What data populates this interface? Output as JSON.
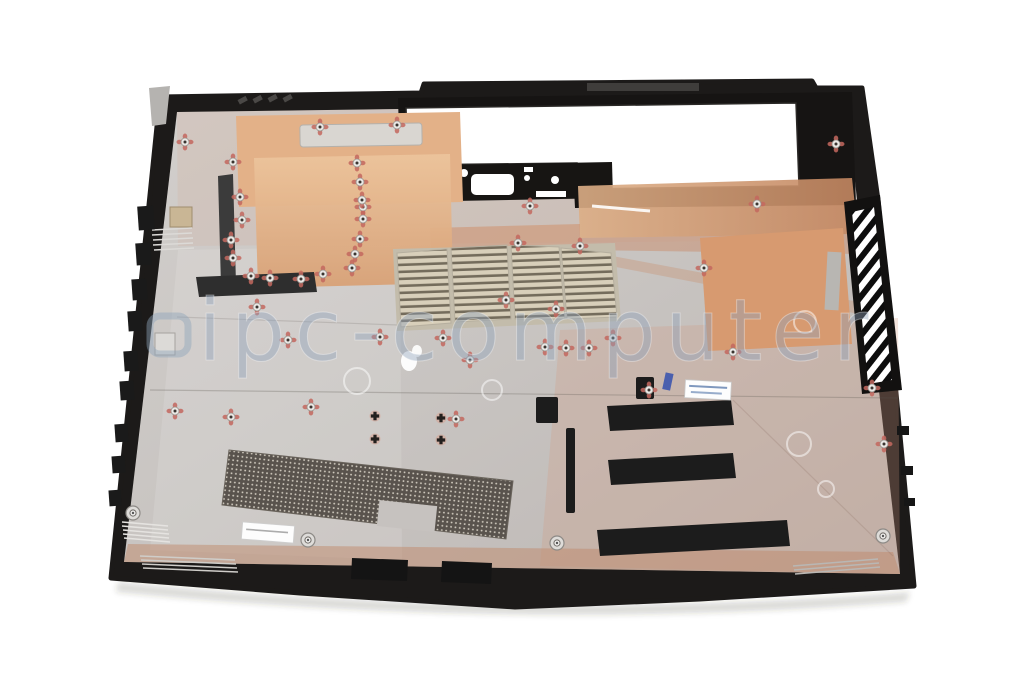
{
  "image": {
    "kind": "product-photo",
    "subject": "Laptop bottom case (base enclosure), interior view with copper shielding",
    "background_color": "#ffffff"
  },
  "watermark": {
    "text": "ipc-computer",
    "color": "#8fa3ba"
  },
  "colors": {
    "case_plastic": "#1c1a19",
    "metal_surface": "#c8c4c1",
    "copper_foil": "#e3b188",
    "copper_foil_deep": "#d79a70",
    "copper_strip": "#d7a078",
    "vent_slat_frame": "#c3bcab",
    "foam_pad": "#1c1c1c",
    "dark_strip": "#3b3b3b",
    "mesh_dark": "#59534d",
    "screw_ring_pink": "#c4685f",
    "label_white": "#fdfdfd",
    "bottom_band_copper": "#c08a6c"
  },
  "stickers": [
    {
      "name": "part-number-sticker",
      "location": "center-right",
      "legible": false
    },
    {
      "name": "serial-sticker",
      "location": "bottom-left",
      "legible": false
    }
  ]
}
